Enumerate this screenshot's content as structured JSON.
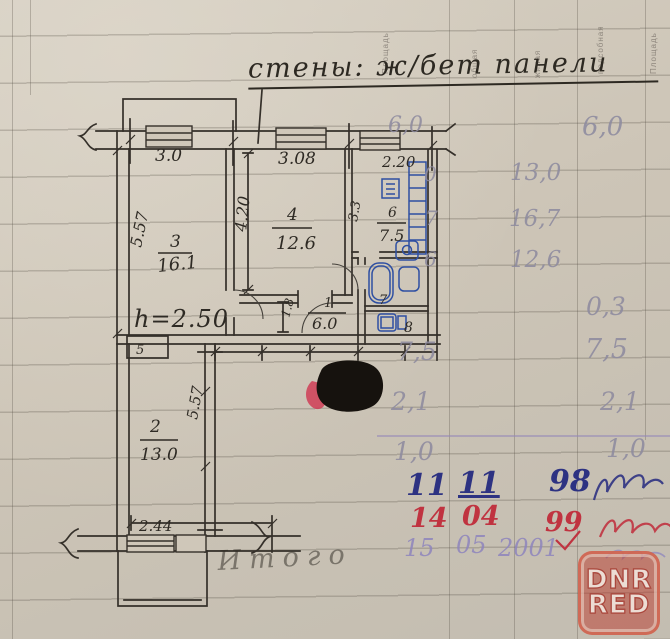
{
  "note": {
    "walls": "стены: ж/бет панели"
  },
  "plan": {
    "dim_top": [
      "3.0",
      "3.08",
      "2.20"
    ],
    "room3": {
      "num": "3",
      "area": "16.1",
      "depth": "5.57"
    },
    "room4": {
      "num": "4",
      "area": "12.6",
      "depth": "4.20"
    },
    "kitchen": {
      "num": "6",
      "area": "7.5",
      "depth": "3.3"
    },
    "hall": {
      "num": "1",
      "area": "6.0",
      "width": "1.8"
    },
    "bath": {
      "num": "7"
    },
    "wc": {
      "num": "8"
    },
    "closet": {
      "num": "5"
    },
    "room2": {
      "num": "2",
      "area": "13.0",
      "depth": "5.57"
    },
    "balcony": {
      "width": "2.44"
    },
    "height_note": "h=2.50",
    "total_label": "Итого"
  },
  "side_table": {
    "headers": [
      "Площадь",
      "общая",
      "жилая",
      "подсобная",
      "Площадь"
    ],
    "cells": {
      "r1_left": "6,0",
      "r1_right": "6,0",
      "r2_partial": "0",
      "r2_mid": "13,0",
      "r3_partial": "7",
      "r3_mid": "16,7",
      "r4_partial": "6",
      "r4_mid": "12,6",
      "r5_right": "0,3",
      "r6_left": "7,5",
      "r6_right": "7,5",
      "r7_left": "2,1",
      "r7_right": "2,1",
      "r8_left": "1,0",
      "r8_right": "1,0"
    }
  },
  "inspections": {
    "blue": {
      "day": "11",
      "month": "11",
      "year": "98"
    },
    "red": {
      "day": "14",
      "month": "04",
      "year": "99"
    },
    "purple": {
      "day": "15",
      "month": "05",
      "year": "2001"
    }
  },
  "watermark": {
    "line1": "DNR",
    "line2": "RED"
  },
  "colors": {
    "ink": "#35302a",
    "blue_pen": "#2d3282",
    "red_pen": "#c03340",
    "purple_pen": "#8e85bd",
    "pencil": "#8e8b9f",
    "stamp_red": "#ba3c30",
    "paper": "#cdc5b7"
  }
}
